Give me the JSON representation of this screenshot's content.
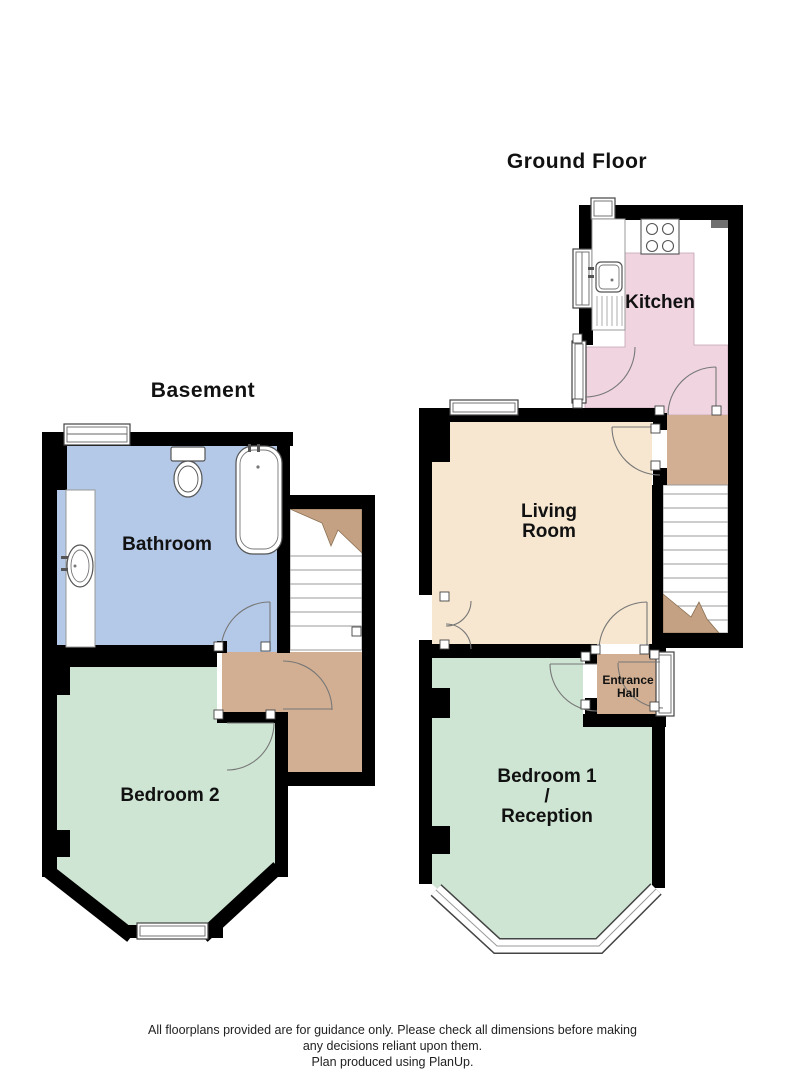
{
  "titles": {
    "basement": "Basement",
    "ground_floor": "Ground Floor"
  },
  "rooms": {
    "bathroom": "Bathroom",
    "bedroom2": "Bedroom 2",
    "kitchen": "Kitchen",
    "living": {
      "line1": "Living",
      "line2": "Room"
    },
    "entrance_hall": {
      "line1": "Entrance",
      "line2": "Hall"
    },
    "bedroom1": {
      "line1": "Bedroom 1",
      "line2": "/",
      "line3": "Reception"
    }
  },
  "footer": {
    "line1": "All floorplans provided are for guidance only. Please check all dimensions before making",
    "line2": "any decisions reliant upon them.",
    "line3": "Plan produced using PlanUp."
  },
  "colors": {
    "wall": "#000000",
    "bathroom_floor": "#b4c9e7",
    "bedroom_floor": "#cee5d3",
    "kitchen_floor": "#f0d5e1",
    "living_floor": "#f7e7d0",
    "hall_floor": "#d2af92",
    "stair_break": "#c4a183",
    "vent": "#6f6f6f"
  }
}
